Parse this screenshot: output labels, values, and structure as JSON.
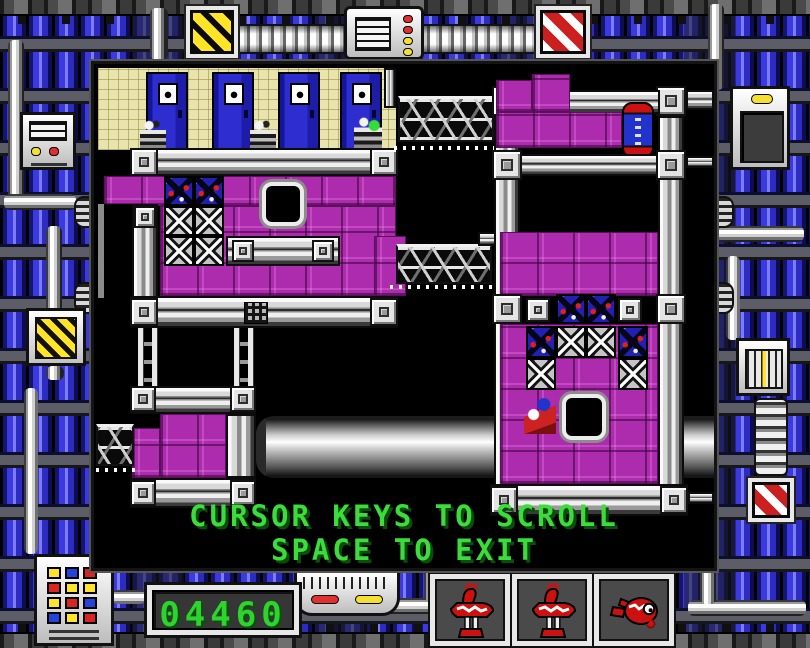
{
  "game": {
    "instructions": [
      "CURSOR KEYS TO SCROLL",
      "SPACE TO EXIT"
    ],
    "score": "04460",
    "lives": [
      {
        "icon": "robot-standing"
      },
      {
        "icon": "robot-standing"
      },
      {
        "icon": "robot-fallen"
      }
    ],
    "colors": {
      "instruction_green": "#3ddc3d",
      "score_green": "#2ed42e",
      "block_magenta": "#ad2cad",
      "pipe_blue": "#3a3ae0",
      "hazard_yellow": "#ffe428",
      "hazard_red": "#cc2020"
    }
  },
  "keypad": {
    "rows": [
      [
        "#ffe428",
        "#2244dd",
        "#dd2222"
      ],
      [
        "#dd2222",
        "#ffe428",
        "#ffe428"
      ],
      [
        "#ffe428",
        "#dd2222",
        "#2244dd"
      ],
      [
        "#2244dd",
        "#ffe428",
        "#dd2222"
      ]
    ]
  },
  "map": {
    "elements": [
      {
        "t": "bigpipe",
        "x": 162,
        "y": 352,
        "w": 458,
        "h": 62
      },
      {
        "t": "wall",
        "x": 4,
        "y": 4,
        "w": 298,
        "h": 82
      },
      {
        "t": "door",
        "x": 52,
        "y": 8,
        "w": 42,
        "h": 78
      },
      {
        "t": "door",
        "x": 118,
        "y": 8,
        "w": 42,
        "h": 78
      },
      {
        "t": "door",
        "x": 184,
        "y": 8,
        "w": 42,
        "h": 78
      },
      {
        "t": "door",
        "x": 246,
        "y": 8,
        "w": 42,
        "h": 78
      },
      {
        "t": "beamv",
        "x": 290,
        "y": 4,
        "w": 12,
        "h": 40
      },
      {
        "t": "bot",
        "x": 46,
        "y": 56,
        "w": 26,
        "h": 30
      },
      {
        "t": "bot",
        "x": 156,
        "y": 56,
        "w": 26,
        "h": 30
      },
      {
        "t": "botg",
        "x": 260,
        "y": 52,
        "w": 28,
        "h": 34
      },
      {
        "t": "beam",
        "x": 36,
        "y": 84,
        "w": 268,
        "h": 28
      },
      {
        "t": "corner",
        "x": 36,
        "y": 84,
        "w": 28,
        "h": 28
      },
      {
        "t": "corner",
        "x": 276,
        "y": 84,
        "w": 28,
        "h": 28
      },
      {
        "t": "mb",
        "x": 10,
        "y": 112,
        "w": 292,
        "h": 30
      },
      {
        "t": "mb",
        "x": 66,
        "y": 142,
        "w": 236,
        "h": 90
      },
      {
        "t": "mb",
        "x": 280,
        "y": 172,
        "w": 32,
        "h": 60
      },
      {
        "t": "blackbox",
        "x": 4,
        "y": 140,
        "w": 34,
        "h": 94
      },
      {
        "t": "beamv",
        "x": 38,
        "y": 140,
        "w": 26,
        "h": 94
      },
      {
        "t": "rivet",
        "x": 40,
        "y": 142,
        "w": 22,
        "h": 22
      },
      {
        "t": "xblue",
        "x": 70,
        "y": 112,
        "w": 30,
        "h": 30
      },
      {
        "t": "xblue",
        "x": 100,
        "y": 112,
        "w": 30,
        "h": 30
      },
      {
        "t": "xwhite",
        "x": 70,
        "y": 142,
        "w": 30,
        "h": 30
      },
      {
        "t": "xwhite",
        "x": 100,
        "y": 142,
        "w": 30,
        "h": 30
      },
      {
        "t": "xwhite",
        "x": 70,
        "y": 172,
        "w": 30,
        "h": 30
      },
      {
        "t": "xwhite",
        "x": 100,
        "y": 172,
        "w": 30,
        "h": 30
      },
      {
        "t": "hole",
        "x": 168,
        "y": 118,
        "w": 42,
        "h": 44
      },
      {
        "t": "beam",
        "x": 132,
        "y": 172,
        "w": 114,
        "h": 30
      },
      {
        "t": "rivet",
        "x": 138,
        "y": 176,
        "w": 22,
        "h": 22
      },
      {
        "t": "rivet",
        "x": 218,
        "y": 176,
        "w": 22,
        "h": 22
      },
      {
        "t": "beam",
        "x": 36,
        "y": 232,
        "w": 268,
        "h": 32
      },
      {
        "t": "corner",
        "x": 36,
        "y": 234,
        "w": 28,
        "h": 28
      },
      {
        "t": "corner",
        "x": 276,
        "y": 234,
        "w": 28,
        "h": 28
      },
      {
        "t": "ventgrid",
        "x": 150,
        "y": 238,
        "w": 24,
        "h": 22
      },
      {
        "t": "ladder",
        "x": 44,
        "y": 264,
        "w": 20,
        "h": 58
      },
      {
        "t": "ladder",
        "x": 140,
        "y": 264,
        "w": 20,
        "h": 58
      },
      {
        "t": "girder",
        "x": 304,
        "y": 32,
        "w": 96,
        "h": 46
      },
      {
        "t": "dots",
        "x": 300,
        "y": 82,
        "w": 104,
        "h": 4
      },
      {
        "t": "girder",
        "x": 302,
        "y": 180,
        "w": 96,
        "h": 40
      },
      {
        "t": "dots",
        "x": 296,
        "y": 221,
        "w": 106,
        "h": 4
      },
      {
        "t": "beam",
        "x": 384,
        "y": 168,
        "w": 28,
        "h": 14
      },
      {
        "t": "corner",
        "x": 398,
        "y": 22,
        "w": 30,
        "h": 30
      },
      {
        "t": "corner",
        "x": 562,
        "y": 22,
        "w": 30,
        "h": 30
      },
      {
        "t": "beamv",
        "x": 400,
        "y": 52,
        "w": 26,
        "h": 372
      },
      {
        "t": "beamv",
        "x": 564,
        "y": 52,
        "w": 26,
        "h": 372
      },
      {
        "t": "beam",
        "x": 426,
        "y": 26,
        "w": 140,
        "h": 24
      },
      {
        "t": "beam",
        "x": 592,
        "y": 26,
        "w": 28,
        "h": 20
      },
      {
        "t": "mb",
        "x": 402,
        "y": 16,
        "w": 36,
        "h": 32
      },
      {
        "t": "mb",
        "x": 438,
        "y": 10,
        "w": 38,
        "h": 38
      },
      {
        "t": "mb",
        "x": 402,
        "y": 48,
        "w": 126,
        "h": 36
      },
      {
        "t": "machine",
        "x": 528,
        "y": 38,
        "w": 32,
        "h": 56
      },
      {
        "t": "beam",
        "x": 426,
        "y": 90,
        "w": 138,
        "h": 22
      },
      {
        "t": "corner",
        "x": 398,
        "y": 86,
        "w": 30,
        "h": 30
      },
      {
        "t": "corner",
        "x": 562,
        "y": 86,
        "w": 30,
        "h": 30
      },
      {
        "t": "beam",
        "x": 592,
        "y": 92,
        "w": 28,
        "h": 12
      },
      {
        "t": "mb",
        "x": 406,
        "y": 168,
        "w": 158,
        "h": 64
      },
      {
        "t": "corner",
        "x": 398,
        "y": 230,
        "w": 30,
        "h": 30
      },
      {
        "t": "rivet",
        "x": 432,
        "y": 234,
        "w": 24,
        "h": 24
      },
      {
        "t": "xblue",
        "x": 462,
        "y": 230,
        "w": 30,
        "h": 30
      },
      {
        "t": "xblue",
        "x": 492,
        "y": 230,
        "w": 30,
        "h": 30
      },
      {
        "t": "rivet",
        "x": 524,
        "y": 234,
        "w": 24,
        "h": 24
      },
      {
        "t": "corner",
        "x": 562,
        "y": 230,
        "w": 30,
        "h": 30
      },
      {
        "t": "mb",
        "x": 406,
        "y": 260,
        "w": 158,
        "h": 160
      },
      {
        "t": "xblue",
        "x": 432,
        "y": 262,
        "w": 30,
        "h": 32
      },
      {
        "t": "xwhite",
        "x": 462,
        "y": 262,
        "w": 30,
        "h": 32
      },
      {
        "t": "xwhite",
        "x": 492,
        "y": 262,
        "w": 30,
        "h": 32
      },
      {
        "t": "xblue",
        "x": 524,
        "y": 262,
        "w": 30,
        "h": 32
      },
      {
        "t": "xwhite",
        "x": 432,
        "y": 294,
        "w": 30,
        "h": 32
      },
      {
        "t": "xwhite",
        "x": 524,
        "y": 294,
        "w": 30,
        "h": 32
      },
      {
        "t": "hole",
        "x": 468,
        "y": 330,
        "w": 44,
        "h": 46
      },
      {
        "t": "bot2",
        "x": 430,
        "y": 334,
        "w": 32,
        "h": 36
      },
      {
        "t": "beam",
        "x": 396,
        "y": 420,
        "w": 198,
        "h": 32
      },
      {
        "t": "corner",
        "x": 396,
        "y": 422,
        "w": 28,
        "h": 28
      },
      {
        "t": "corner",
        "x": 566,
        "y": 422,
        "w": 28,
        "h": 28
      },
      {
        "t": "beam",
        "x": 594,
        "y": 428,
        "w": 26,
        "h": 12
      },
      {
        "t": "beam",
        "x": 36,
        "y": 322,
        "w": 126,
        "h": 28
      },
      {
        "t": "corner",
        "x": 36,
        "y": 322,
        "w": 26,
        "h": 26
      },
      {
        "t": "corner",
        "x": 136,
        "y": 322,
        "w": 26,
        "h": 26
      },
      {
        "t": "mb",
        "x": 66,
        "y": 350,
        "w": 66,
        "h": 64
      },
      {
        "t": "mb",
        "x": 38,
        "y": 364,
        "w": 28,
        "h": 50
      },
      {
        "t": "beamv",
        "x": 132,
        "y": 350,
        "w": 30,
        "h": 64
      },
      {
        "t": "beam",
        "x": 36,
        "y": 414,
        "w": 126,
        "h": 30
      },
      {
        "t": "corner",
        "x": 36,
        "y": 416,
        "w": 26,
        "h": 26
      },
      {
        "t": "corner",
        "x": 136,
        "y": 416,
        "w": 26,
        "h": 26
      },
      {
        "t": "girder",
        "x": 2,
        "y": 360,
        "w": 38,
        "h": 42
      },
      {
        "t": "dots",
        "x": 2,
        "y": 404,
        "w": 44,
        "h": 4
      }
    ]
  }
}
